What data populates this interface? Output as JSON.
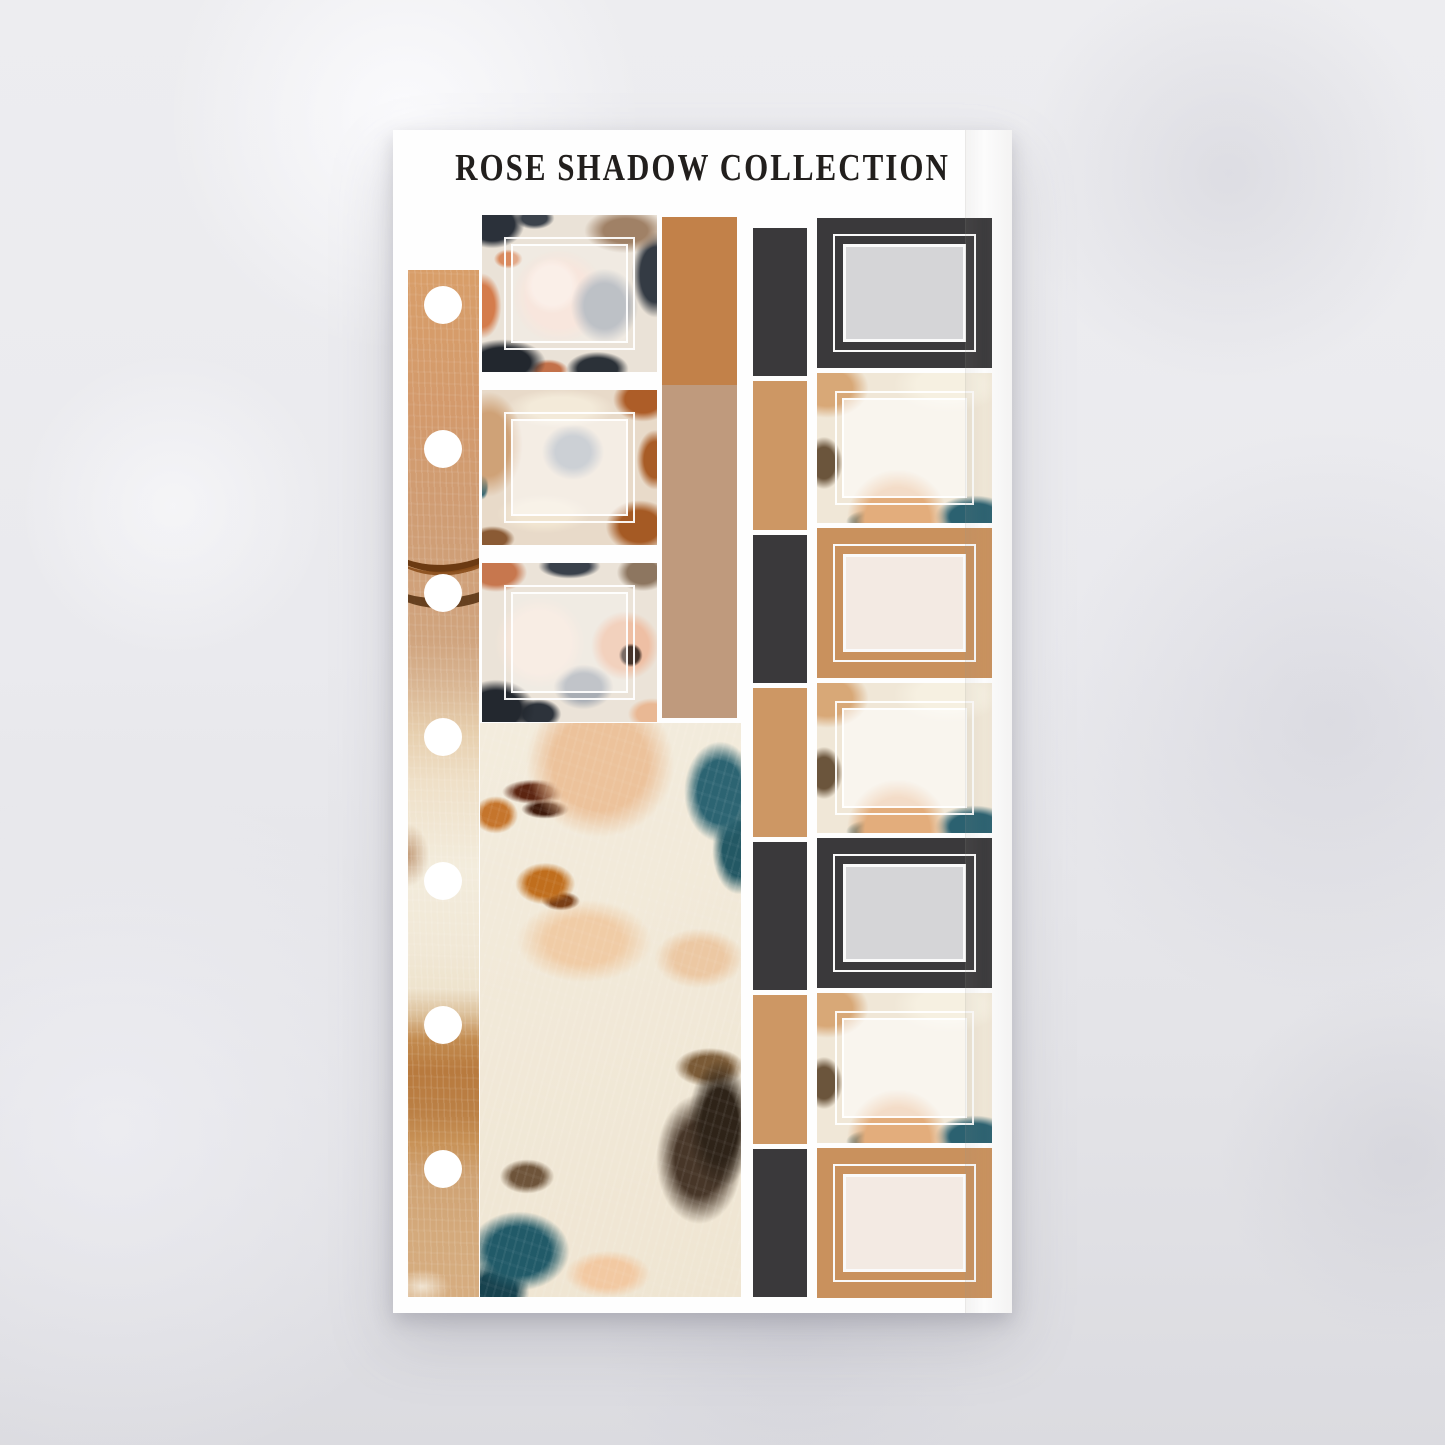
{
  "sheet": {
    "title": "ROSE SHADOW COLLECTION",
    "palette": {
      "tan": "#c9915d",
      "tan_dark": "#c28149",
      "tan_muted": "#bf9a7d",
      "charcoal": "#3a393b",
      "gray_swatch": "#d5d5d7",
      "cream_swatch": "#f3eae3",
      "teal": "#2c6372",
      "rust": "#ad5d28",
      "peach": "#ecc29b",
      "sheet_white": "#fefefe",
      "title_color": "#221f1d"
    },
    "left_strip": {
      "hole_count": 7,
      "hole_color": "#ffffff"
    },
    "middle_column": {
      "squares": [
        "floral-frame",
        "paint-frame",
        "floral-frame"
      ],
      "color_blocks": [
        "tan-dark",
        "tan-muted"
      ],
      "large_block": "abstract-paint"
    },
    "spacer_column": {
      "blocks": [
        "charcoal",
        "tan",
        "charcoal",
        "tan",
        "charcoal",
        "tan",
        "charcoal"
      ]
    },
    "right_column": {
      "squares": [
        "charcoal-frame",
        "floral-frosted",
        "tan-frame",
        "floral-frosted",
        "charcoal-frame",
        "floral-frosted",
        "tan-frame"
      ]
    }
  }
}
